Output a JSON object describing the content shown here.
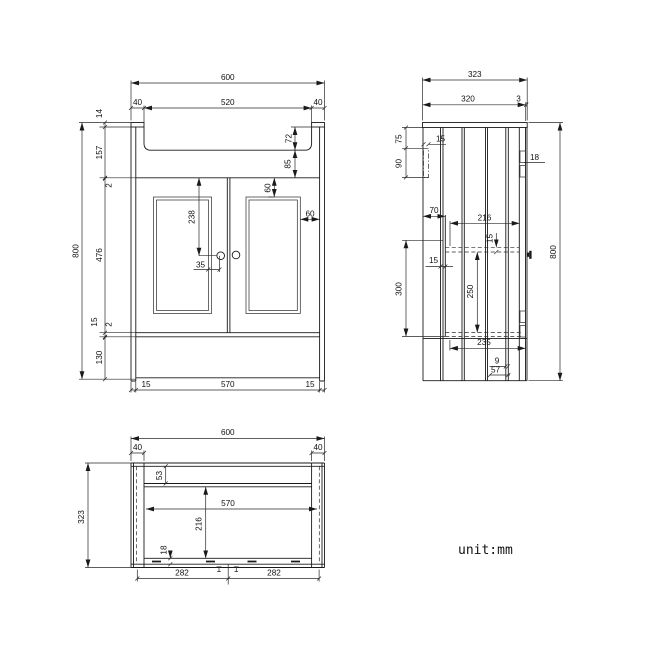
{
  "front": {
    "overall_width": "600",
    "basin_opening": "520",
    "leg_left": "40",
    "leg_right": "40",
    "top_thickness": "14",
    "apron_height": "157",
    "gap_upper": "2",
    "door_height": "476",
    "bottom_rail": "15",
    "gap_lower": "2",
    "plinth_height": "130",
    "overall_height": "800",
    "basin_depth": "72",
    "basin_clearance": "85",
    "panel_top_inset": "60",
    "panel_side_inset": "60",
    "handle_drop": "238",
    "handle_offset": "35",
    "base_inset_left": "15",
    "base_width": "570",
    "base_inset_right": "15"
  },
  "side": {
    "overall_depth": "323",
    "top_depth": "320",
    "top_overhang": "3",
    "bracket_drop": "75",
    "bracket_width": "15",
    "bracket_height": "90",
    "hinge_plate": "18",
    "front_clearance": "70",
    "shelf_depth": "216",
    "shelf_thickness": "15",
    "panel_thickness": "15",
    "opening_height": "300",
    "shelf_spacing": "250",
    "base_depth": "235",
    "back_gap": "9",
    "back_inset": "57",
    "overall_height": "800"
  },
  "plan": {
    "overall_width": "600",
    "leg_left": "40",
    "leg_right": "40",
    "front_rail": "53",
    "inner_width": "570",
    "inner_depth": "216",
    "back_gap": "18",
    "overall_depth": "323",
    "door_left": "282",
    "door_right": "282"
  },
  "note": {
    "unit_label": "unit:mm"
  }
}
